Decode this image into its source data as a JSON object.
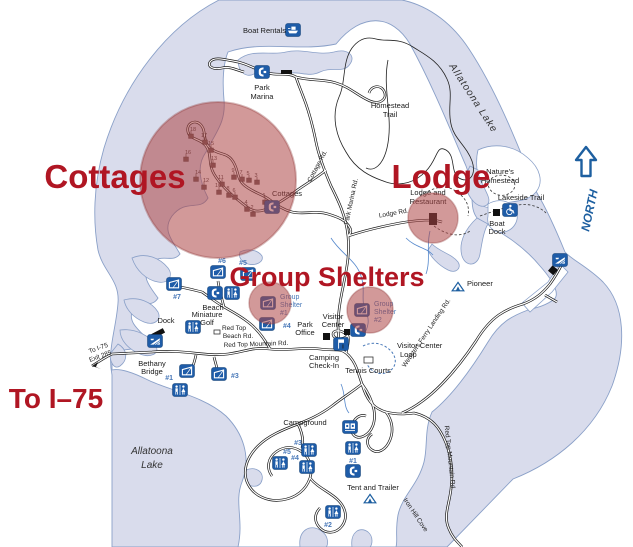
{
  "map": {
    "region_titles": {
      "cottages": "Cottages",
      "lodge": "Lodge",
      "group_shelters": "Group Shelters",
      "to_i75": "To I–75"
    },
    "compass": {
      "north": "NORTH"
    },
    "lake": {
      "top_name": "Allatoona Lake",
      "bottom_name": [
        "Allatoona",
        "Lake"
      ]
    },
    "places": {
      "boat_rentals": "Boat Rentals",
      "park_marina": [
        "Park",
        "Marina"
      ],
      "homestead_trail": [
        "Homestead",
        "Trail"
      ],
      "natures_homestead": [
        "Nature's",
        "Homestead"
      ],
      "lakeside_trail": "Lakeside Trail",
      "boat_dock": [
        "Boat",
        "Dock"
      ],
      "lodge_and_restaurant": [
        "Lodge and",
        "Restaurant"
      ],
      "cottages_small": "Cottages",
      "pioneer": "Pioneer",
      "beach": "Beach",
      "miniature_golf": [
        "Miniature",
        "Golf"
      ],
      "dock": "Dock",
      "bethany_bridge": [
        "Bethany",
        "Bridge"
      ],
      "park_office": [
        "Park",
        "Office"
      ],
      "visitor_center": [
        "Visitor",
        "Center"
      ],
      "camping_check_in": [
        "Camping",
        "Check-In"
      ],
      "visitor_center_loop": [
        "Visitor Center",
        "Loop"
      ],
      "tennis_courts": "Tennis Courts",
      "campground": "Campground",
      "tent_and_trailer": "Tent and Trailer",
      "group_shelter_1": [
        "Group",
        "Shelter",
        "#1"
      ],
      "group_shelter_2": [
        "Group",
        "Shelter",
        "#2"
      ]
    },
    "roads": {
      "cottage_rd": "Cottage Rd.",
      "park_marina_rd": "Park Marina Rd.",
      "lodge_rd": "Lodge Rd.",
      "red_top_beach_rd": [
        "Red Top",
        "Beach Rd."
      ],
      "red_top_mountain_rd": "Red Top Mountain Rd.",
      "red_top_mountain_rd_south": "Red Top Mountain Rd.",
      "websters_ferry_landing_rd": "Websters Ferry Landing Rd.",
      "iron_hill_cove": "Iron Hill Cove",
      "to_i75_exit": [
        "To I-75",
        "Exit 285"
      ]
    },
    "shelter_numbers": {
      "n1": "#1",
      "n3": "#3",
      "n4": "#4",
      "n5": "#5",
      "n6": "#6",
      "n7": "#7"
    },
    "campsite_numbers": {
      "c1": "#1",
      "c2": "#2",
      "c3": "#3",
      "c4": "#4",
      "c5": "#5"
    },
    "cottage_numbers": [
      "18",
      "17",
      "16",
      "15",
      "14",
      "13",
      "12",
      "11",
      "10",
      "9",
      "8",
      "7",
      "6",
      "5",
      "4",
      "3",
      "2",
      "1"
    ]
  }
}
